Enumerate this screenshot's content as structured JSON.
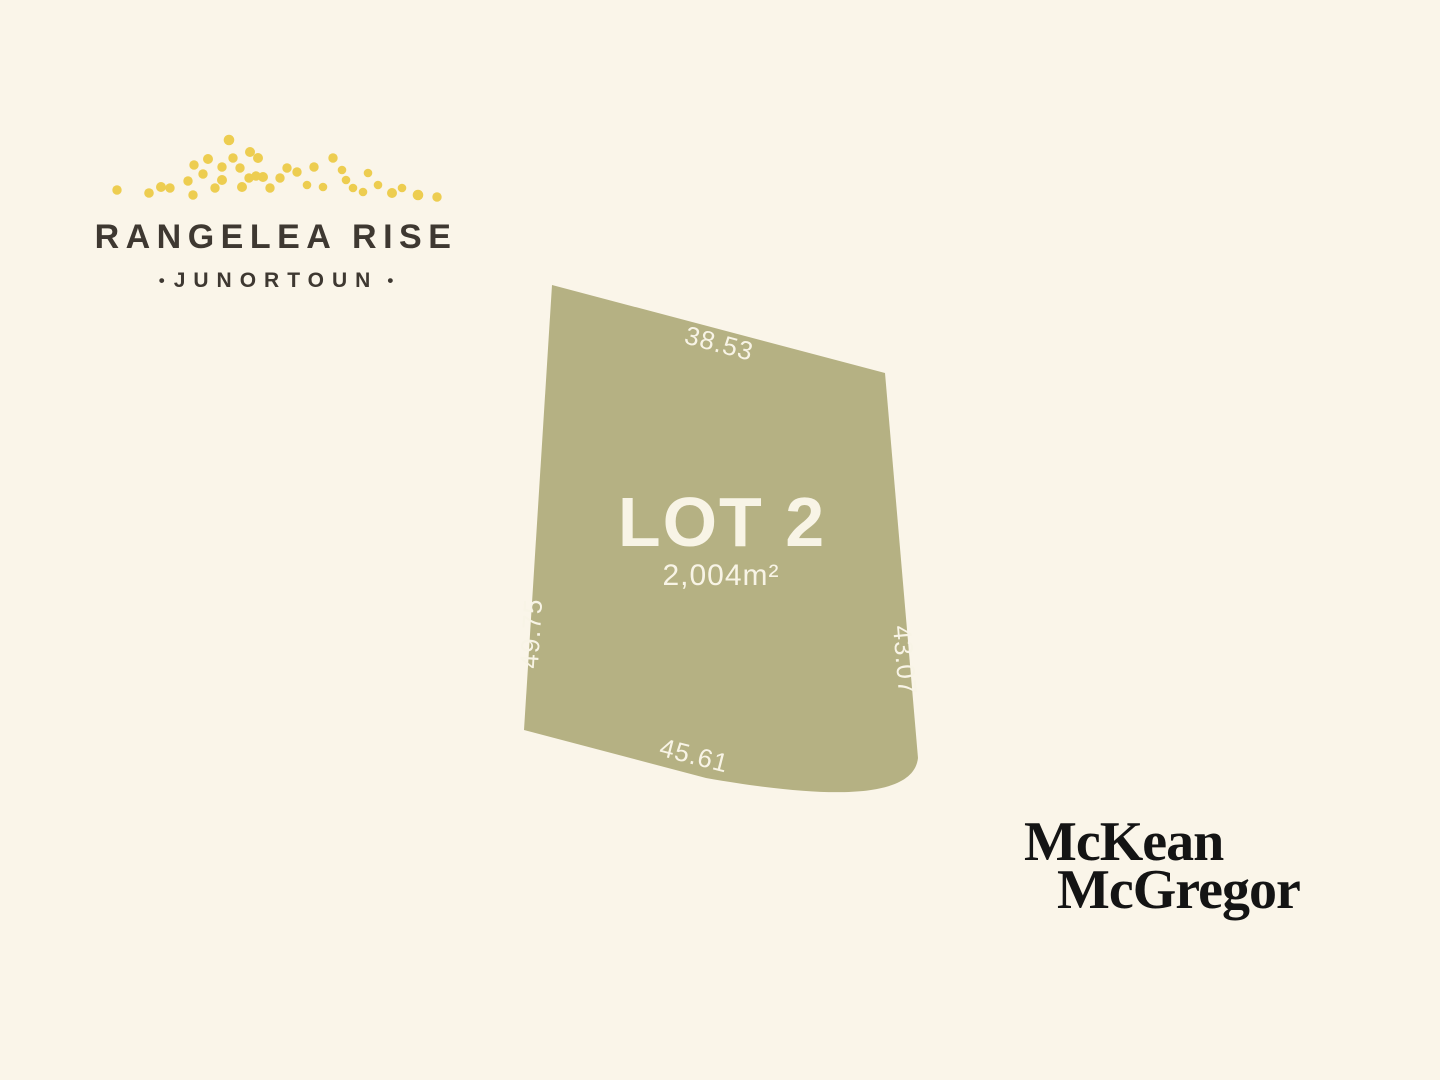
{
  "branding": {
    "estate_name": "RANGELEA RISE",
    "location": "JUNORTOUN",
    "separator_dot": "•"
  },
  "lot": {
    "name": "LOT 2",
    "area": "2,004m²",
    "boundaries": {
      "top": "38.53",
      "right": "43.07",
      "bottom": "45.61",
      "left": "49.75"
    }
  },
  "agency": {
    "name_line1": "McKean",
    "name_line2": "McGregor"
  },
  "colors": {
    "background": "#FAF5E9",
    "parcel_fill": "#B5B183",
    "parcel_text": "#F8F4E6",
    "logo_dots": "#EDCD50",
    "brand_text": "#3E3831",
    "agency_text": "#141414"
  }
}
